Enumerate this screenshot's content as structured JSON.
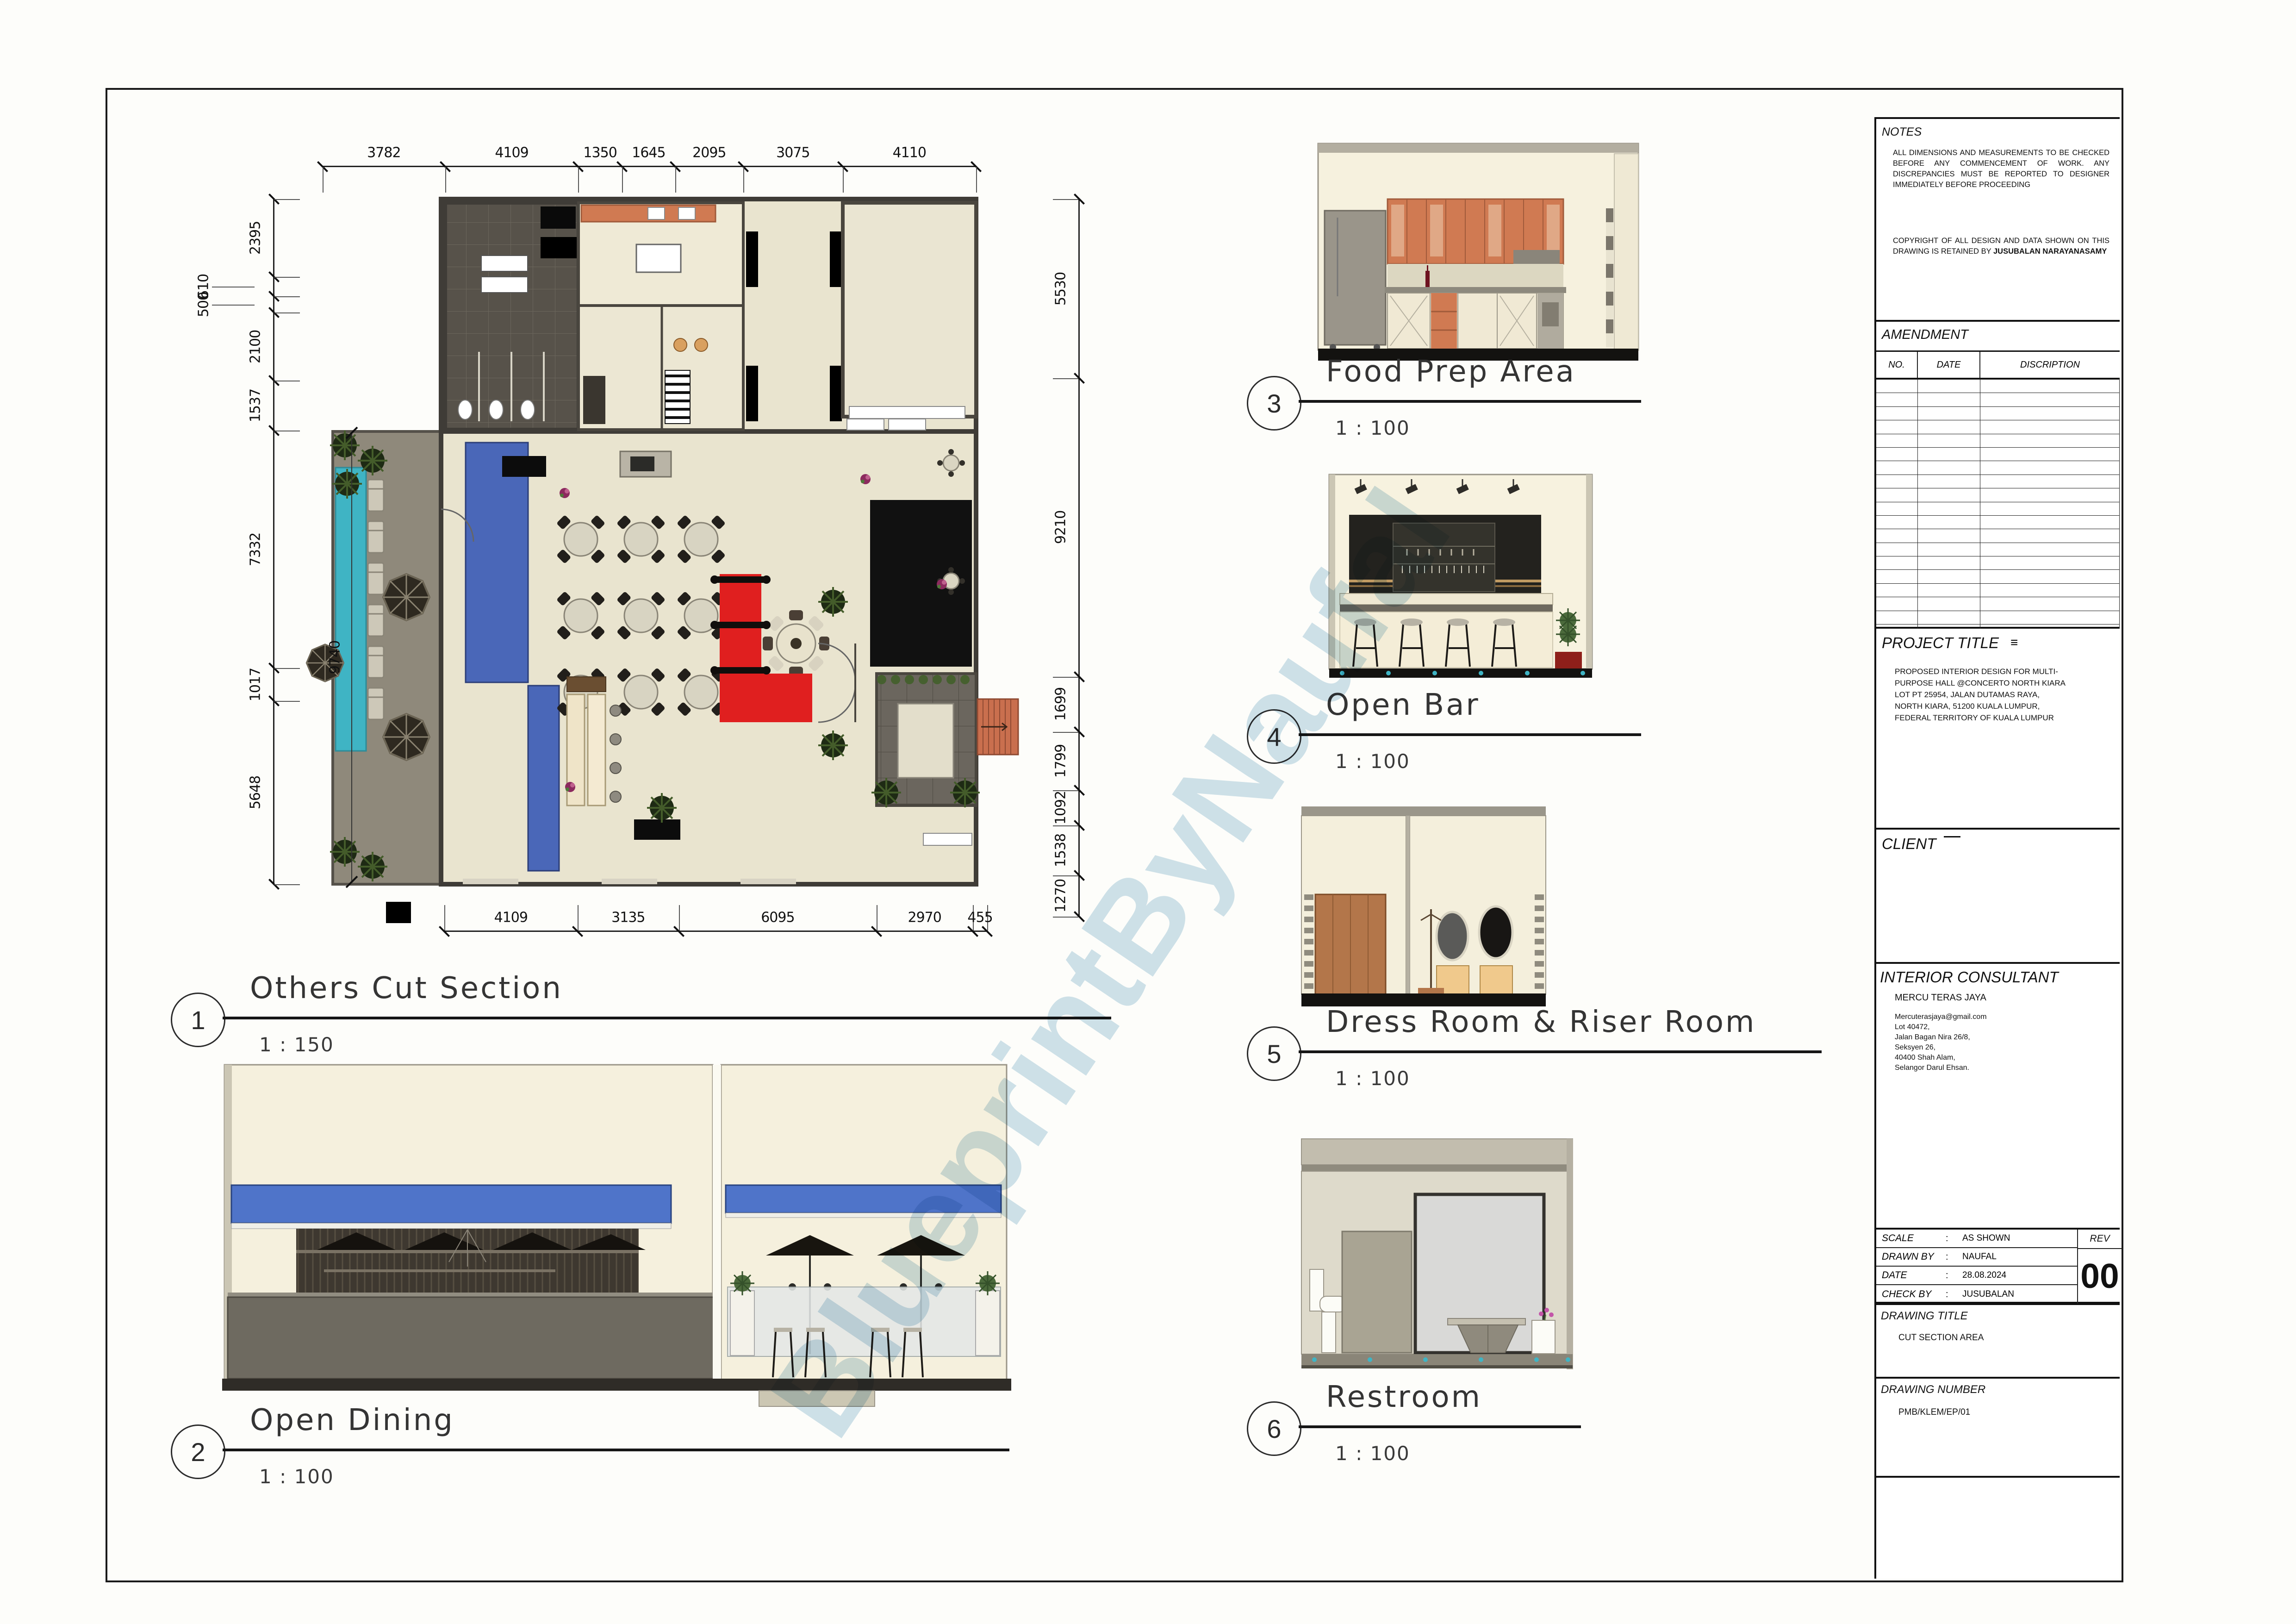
{
  "palette": {
    "carpet_blue": "#4a67b8",
    "awning_blue": "#4f74c9",
    "pool_teal": "#3fb4c4",
    "red_carpet": "#e01f1f",
    "cabinet_orange": "#d07a52",
    "stage_black": "#111111",
    "floor_beige": "#e9e4cf",
    "terrace_taupe": "#8f897b",
    "wall_dark": "#3f3c37",
    "wm": "#9fc6da"
  },
  "watermark": {
    "text": "BlueprintByNaufal"
  },
  "drawings": [
    {
      "no": "1",
      "title": "Others Cut Section",
      "scale": "1 : 150"
    },
    {
      "no": "2",
      "title": "Open Dining",
      "scale": "1 : 100"
    },
    {
      "no": "3",
      "title": "Food Prep Area",
      "scale": "1 : 100"
    },
    {
      "no": "4",
      "title": "Open Bar",
      "scale": "1 : 100"
    },
    {
      "no": "5",
      "title": "Dress Room & Riser Room",
      "scale": "1 : 100"
    },
    {
      "no": "6",
      "title": "Restroom",
      "scale": "1 : 100"
    }
  ],
  "plan_dims": {
    "top": [
      3782,
      4109,
      1350,
      1645,
      2095,
      3075,
      4110
    ],
    "bottom": [
      4109,
      3135,
      6095,
      2970,
      455
    ],
    "left": [
      2395,
      610,
      500,
      2100,
      1537,
      7332,
      1017,
      5648
    ],
    "right": [
      5530,
      9210,
      1699,
      1799,
      1092,
      1538,
      1270
    ],
    "terrace": "9740"
  },
  "title_block": {
    "notes": {
      "header": "NOTES",
      "para1": "ALL DIMENSIONS AND MEASUREMENTS TO BE CHECKED BEFORE ANY COMMENCEMENT OF WORK. ANY DISCREPANCIES MUST BE REPORTED TO DESIGNER IMMEDIATELY BEFORE PROCEEDING",
      "para2_prefix": "COPYRIGHT OF ALL DESIGN AND DATA SHOWN ON THIS DRAWING IS RETAINED BY ",
      "para2_bold": "JUSUBALAN NARAYANASAMY"
    },
    "amendment": {
      "header": "AMENDMENT",
      "columns": [
        "NO.",
        "DATE",
        "DISCRIPTION"
      ],
      "empty_rows": 19
    },
    "project_title": {
      "header": "PROJECT TITLE",
      "lines": "PROPOSED INTERIOR DESIGN FOR MULTI-\nPURPOSE HALL @CONCERTO NORTH KIARA\nLOT PT 25954, JALAN DUTAMAS RAYA,\nNORTH KIARA, 51200 KUALA LUMPUR,\nFEDERAL TERRITORY OF KUALA LUMPUR"
    },
    "client": {
      "header": "CLIENT"
    },
    "consultant": {
      "header": "INTERIOR CONSULTANT",
      "name": "MERCU TERAS JAYA",
      "lines": "Mercuterasjaya@gmail.com\nLot 40472,\nJalan Bagan Nira 26/8,\nSeksyen 26,\n40400 Shah Alam,\nSelangor Darul Ehsan."
    },
    "meta": {
      "rows": [
        {
          "label": "SCALE",
          "value": "AS SHOWN"
        },
        {
          "label": "DRAWN BY",
          "value": "NAUFAL"
        },
        {
          "label": "DATE",
          "value": "28.08.2024"
        },
        {
          "label": "CHECK BY",
          "value": "JUSUBALAN"
        }
      ],
      "rev_label": "REV",
      "rev_value": "00"
    },
    "drawing_title": {
      "header": "DRAWING TITLE",
      "value": "CUT SECTION AREA"
    },
    "drawing_number": {
      "header": "DRAWING NUMBER",
      "value": "PMB/KLEM/EP/01"
    }
  }
}
